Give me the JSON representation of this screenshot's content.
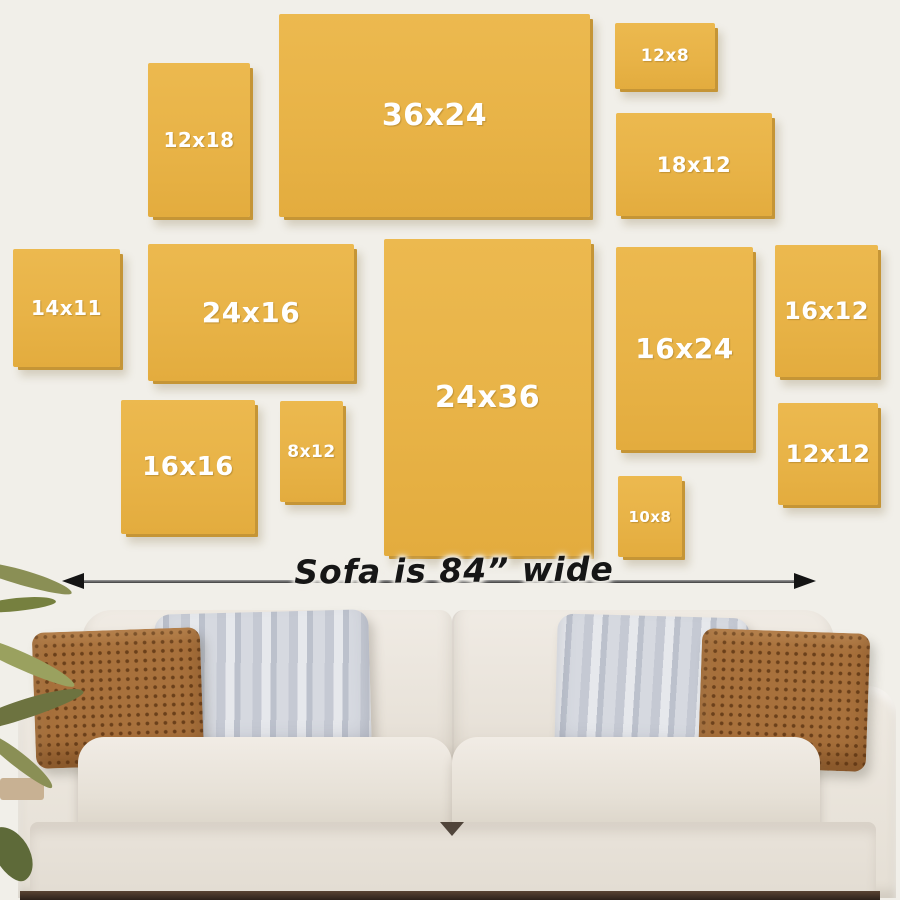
{
  "scene": {
    "description": "Wall-art size guide above a sofa",
    "caption": {
      "text": "Sofa is 84” wide"
    },
    "sofa_width_label_value": "84”",
    "panels": [
      {
        "label": "36x24",
        "width_in": 36,
        "height_in": 24
      },
      {
        "label": "12x18",
        "width_in": 12,
        "height_in": 18
      },
      {
        "label": "12x8",
        "width_in": 12,
        "height_in": 8
      },
      {
        "label": "18x12",
        "width_in": 18,
        "height_in": 12
      },
      {
        "label": "14x11",
        "width_in": 14,
        "height_in": 11
      },
      {
        "label": "24x16",
        "width_in": 24,
        "height_in": 16
      },
      {
        "label": "24x36",
        "width_in": 24,
        "height_in": 36
      },
      {
        "label": "16x24",
        "width_in": 16,
        "height_in": 24
      },
      {
        "label": "16x12",
        "width_in": 16,
        "height_in": 12
      },
      {
        "label": "16x16",
        "width_in": 16,
        "height_in": 16
      },
      {
        "label": "8x12",
        "width_in": 8,
        "height_in": 12
      },
      {
        "label": "12x12",
        "width_in": 12,
        "height_in": 12
      },
      {
        "label": "10x8",
        "width_in": 10,
        "height_in": 8
      }
    ],
    "colors": {
      "wall": "#F1EFE9",
      "panel_fill": "#E8B347",
      "panel_shadow": "#C59536",
      "panel_label_text": "#FFFFFF",
      "caption_text": "#161616",
      "arrow": "#3D3D3D",
      "sofa_fabric": "#EAE4DB",
      "pillow_brown": "#A8713C",
      "pillow_gray": "#C9CCD4",
      "plant_green": "#7D8149"
    }
  }
}
